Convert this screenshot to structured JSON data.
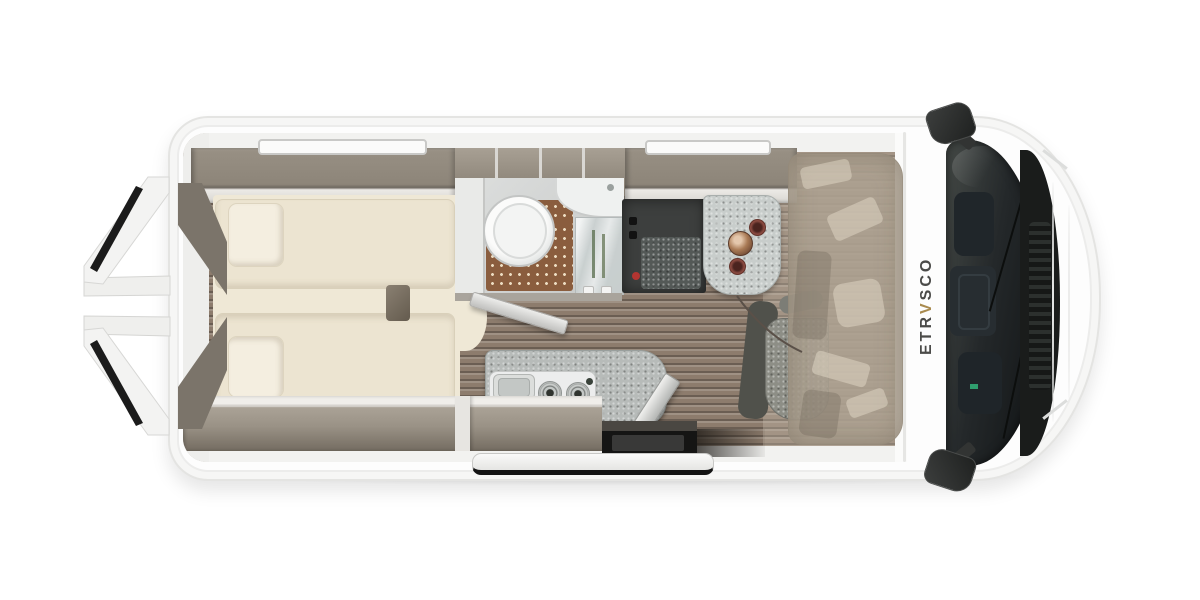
{
  "brand": {
    "name": "ETRVSCO",
    "prefix": "ETR",
    "accent_letter": "V",
    "suffix": "SCO",
    "accent_color": "#A98B4F"
  },
  "floorplan": {
    "vehicle": "camper-van-top-view",
    "areas": [
      {
        "name": "rear-doors-open"
      },
      {
        "name": "rear-twin-beds"
      },
      {
        "name": "overhead-lockers"
      },
      {
        "name": "wet-bathroom"
      },
      {
        "name": "kitchen-block"
      },
      {
        "name": "dinette-bench"
      },
      {
        "name": "dinette-table"
      },
      {
        "name": "swivel-cab-seats"
      },
      {
        "name": "driver-cab"
      },
      {
        "name": "sliding-door-rail"
      },
      {
        "name": "roof-skylights"
      }
    ]
  },
  "palette": {
    "body_white": "#FDFDFD",
    "furniture_taupe": "#9B9387",
    "mattress_cream": "#EFE8D6",
    "floor_wood": "#8D7C6D",
    "shower_mat_brown": "#8A5D3E",
    "dinette_dark": "#3D3F3E",
    "table_gray": "#C8CDCB",
    "windshield_dark": "#1E2322"
  }
}
